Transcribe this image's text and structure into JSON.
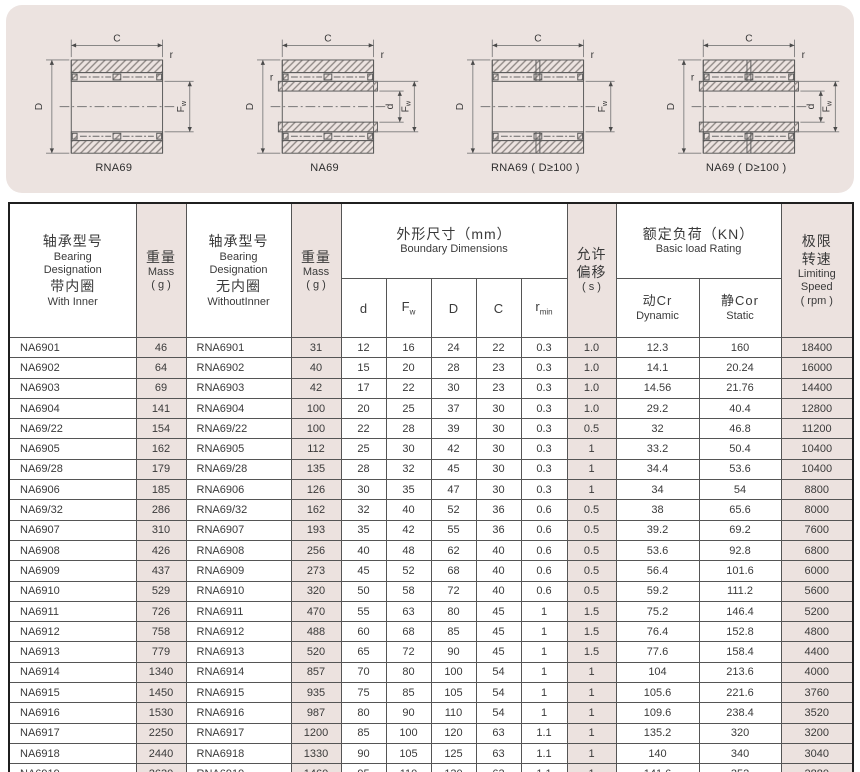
{
  "colors": {
    "panel_bg": "#ece3e0",
    "shade": "#ece2df",
    "inner_border": "#555555",
    "outer_border": "#1f1f1f",
    "text": "#3a3a3a"
  },
  "diagram_labels": {
    "c": "C",
    "r": "r",
    "outer_diameter": "D",
    "fw": "F",
    "fw_sub": "w",
    "bore": "d"
  },
  "diagrams": [
    {
      "caption": "RNA69"
    },
    {
      "caption": "NA69"
    },
    {
      "caption": "RNA69 ( D≥100 )"
    },
    {
      "caption": "NA69 ( D≥100 )"
    }
  ],
  "table": {
    "header": {
      "with_inner": {
        "zh": "轴承型号",
        "en": "Bearing\nDesignation",
        "zh2": "带内圈",
        "en2": "With Inner"
      },
      "mass": {
        "zh": "重量",
        "en": "Mass\n( g )"
      },
      "without_inner": {
        "zh": "轴承型号",
        "en": "Bearing\nDesignation",
        "zh2": "无内圈",
        "en2": "WithoutInner"
      },
      "dims": {
        "zh": "外形尺寸（mm）",
        "en": "Boundary Dimensions"
      },
      "d": "d",
      "fw": "F",
      "fw_sub": "w",
      "D": "D",
      "C": "C",
      "r": "r",
      "r_sub": "min",
      "offset": {
        "zh": "允许\n偏移",
        "en": "( s )"
      },
      "load": {
        "zh": "额定负荷（KN）",
        "en": "Basic load Rating"
      },
      "cr": {
        "zh": "动Cr",
        "en": "Dynamic"
      },
      "cor": {
        "zh": "静Cor",
        "en": "Static"
      },
      "speed": {
        "zh": "极限\n转速",
        "en": "Limiting\nSpeed\n( rpm )"
      }
    },
    "rows": [
      [
        "NA6901",
        "46",
        "RNA6901",
        "31",
        "12",
        "16",
        "24",
        "22",
        "0.3",
        "1.0",
        "12.3",
        "160",
        "18400"
      ],
      [
        "NA6902",
        "64",
        "RNA6902",
        "40",
        "15",
        "20",
        "28",
        "23",
        "0.3",
        "1.0",
        "14.1",
        "20.24",
        "16000"
      ],
      [
        "NA6903",
        "69",
        "RNA6903",
        "42",
        "17",
        "22",
        "30",
        "23",
        "0.3",
        "1.0",
        "14.56",
        "21.76",
        "14400"
      ],
      [
        "NA6904",
        "141",
        "RNA6904",
        "100",
        "20",
        "25",
        "37",
        "30",
        "0.3",
        "1.0",
        "29.2",
        "40.4",
        "12800"
      ],
      [
        "NA69/22",
        "154",
        "RNA69/22",
        "100",
        "22",
        "28",
        "39",
        "30",
        "0.3",
        "0.5",
        "32",
        "46.8",
        "11200"
      ],
      [
        "NA6905",
        "162",
        "RNA6905",
        "112",
        "25",
        "30",
        "42",
        "30",
        "0.3",
        "1",
        "33.2",
        "50.4",
        "10400"
      ],
      [
        "NA69/28",
        "179",
        "RNA69/28",
        "135",
        "28",
        "32",
        "45",
        "30",
        "0.3",
        "1",
        "34.4",
        "53.6",
        "10400"
      ],
      [
        "NA6906",
        "185",
        "RNA6906",
        "126",
        "30",
        "35",
        "47",
        "30",
        "0.3",
        "1",
        "34",
        "54",
        "8800"
      ],
      [
        "NA69/32",
        "286",
        "RNA69/32",
        "162",
        "32",
        "40",
        "52",
        "36",
        "0.6",
        "0.5",
        "38",
        "65.6",
        "8000"
      ],
      [
        "NA6907",
        "310",
        "RNA6907",
        "193",
        "35",
        "42",
        "55",
        "36",
        "0.6",
        "0.5",
        "39.2",
        "69.2",
        "7600"
      ],
      [
        "NA6908",
        "426",
        "RNA6908",
        "256",
        "40",
        "48",
        "62",
        "40",
        "0.6",
        "0.5",
        "53.6",
        "92.8",
        "6800"
      ],
      [
        "NA6909",
        "437",
        "RNA6909",
        "273",
        "45",
        "52",
        "68",
        "40",
        "0.6",
        "0.5",
        "56.4",
        "101.6",
        "6000"
      ],
      [
        "NA6910",
        "529",
        "RNA6910",
        "320",
        "50",
        "58",
        "72",
        "40",
        "0.6",
        "0.5",
        "59.2",
        "111.2",
        "5600"
      ],
      [
        "NA6911",
        "726",
        "RNA6911",
        "470",
        "55",
        "63",
        "80",
        "45",
        "1",
        "1.5",
        "75.2",
        "146.4",
        "5200"
      ],
      [
        "NA6912",
        "758",
        "RNA6912",
        "488",
        "60",
        "68",
        "85",
        "45",
        "1",
        "1.5",
        "76.4",
        "152.8",
        "4800"
      ],
      [
        "NA6913",
        "779",
        "RNA6913",
        "520",
        "65",
        "72",
        "90",
        "45",
        "1",
        "1.5",
        "77.6",
        "158.4",
        "4400"
      ],
      [
        "NA6914",
        "1340",
        "RNA6914",
        "857",
        "70",
        "80",
        "100",
        "54",
        "1",
        "1",
        "104",
        "213.6",
        "4000"
      ],
      [
        "NA6915",
        "1450",
        "RNA6915",
        "935",
        "75",
        "85",
        "105",
        "54",
        "1",
        "1",
        "105.6",
        "221.6",
        "3760"
      ],
      [
        "NA6916",
        "1530",
        "RNA6916",
        "987",
        "80",
        "90",
        "110",
        "54",
        "1",
        "1",
        "109.6",
        "238.4",
        "3520"
      ],
      [
        "NA6917",
        "2250",
        "RNA6917",
        "1200",
        "85",
        "100",
        "120",
        "63",
        "1.1",
        "1",
        "135.2",
        "320",
        "3200"
      ],
      [
        "NA6918",
        "2440",
        "RNA6918",
        "1330",
        "90",
        "105",
        "125",
        "63",
        "1.1",
        "1",
        "140",
        "340",
        "3040"
      ],
      [
        "NA6919",
        "2630",
        "RNA6919",
        "1460",
        "95",
        "110",
        "130",
        "63",
        "1.1",
        "1",
        "141.6",
        "352",
        "2880"
      ]
    ]
  }
}
